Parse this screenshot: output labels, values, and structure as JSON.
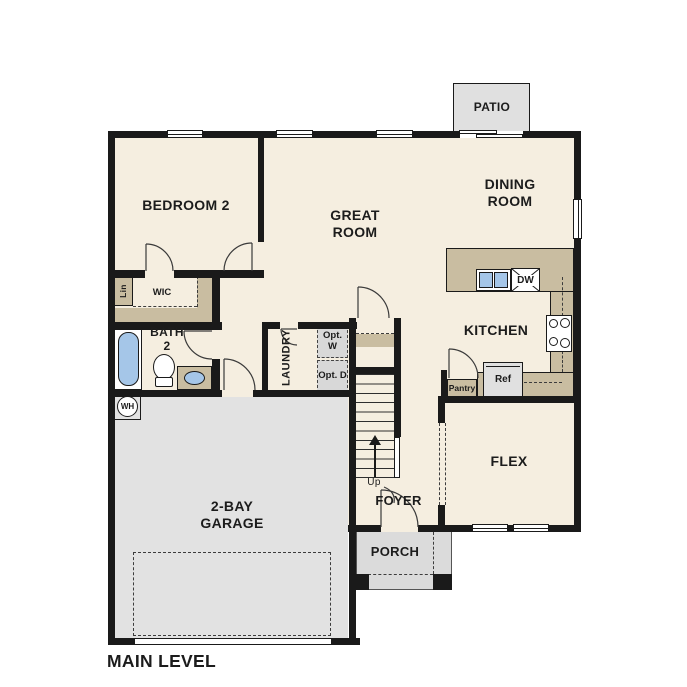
{
  "plan_title": "MAIN LEVEL",
  "colors": {
    "wall": "#1a1a1a",
    "floor": "#f5eee0",
    "counter": "#c9bda1",
    "garage": "#e2e2e2",
    "porch": "#dbdbdb",
    "patio": "#e0e0e0",
    "water": "#a5c6e8",
    "optbox": "#d8d8d8",
    "appliance": "#e0e0e0"
  },
  "rooms": {
    "bedroom2": {
      "label": "BEDROOM 2"
    },
    "great_room": {
      "label": "GREAT ROOM"
    },
    "dining_room": {
      "label": "DINING ROOM"
    },
    "kitchen": {
      "label": "KITCHEN"
    },
    "flex": {
      "label": "FLEX"
    },
    "garage": {
      "label": "2-BAY GARAGE"
    },
    "foyer": {
      "label": "FOYER"
    },
    "porch": {
      "label": "PORCH"
    },
    "patio": {
      "label": "PATIO"
    },
    "bath2": {
      "label": "BATH 2"
    },
    "laundry": {
      "label": "LAUNDRY"
    },
    "wic": {
      "label": "WIC"
    }
  },
  "fixtures": {
    "linen": "Lin",
    "water_heater": "WH",
    "dishwasher": "DW",
    "refrigerator": "Ref",
    "pantry": "Pantry",
    "opt_washer": "Opt. W",
    "opt_dryer": "Opt. D",
    "stairs_up": "Up"
  }
}
